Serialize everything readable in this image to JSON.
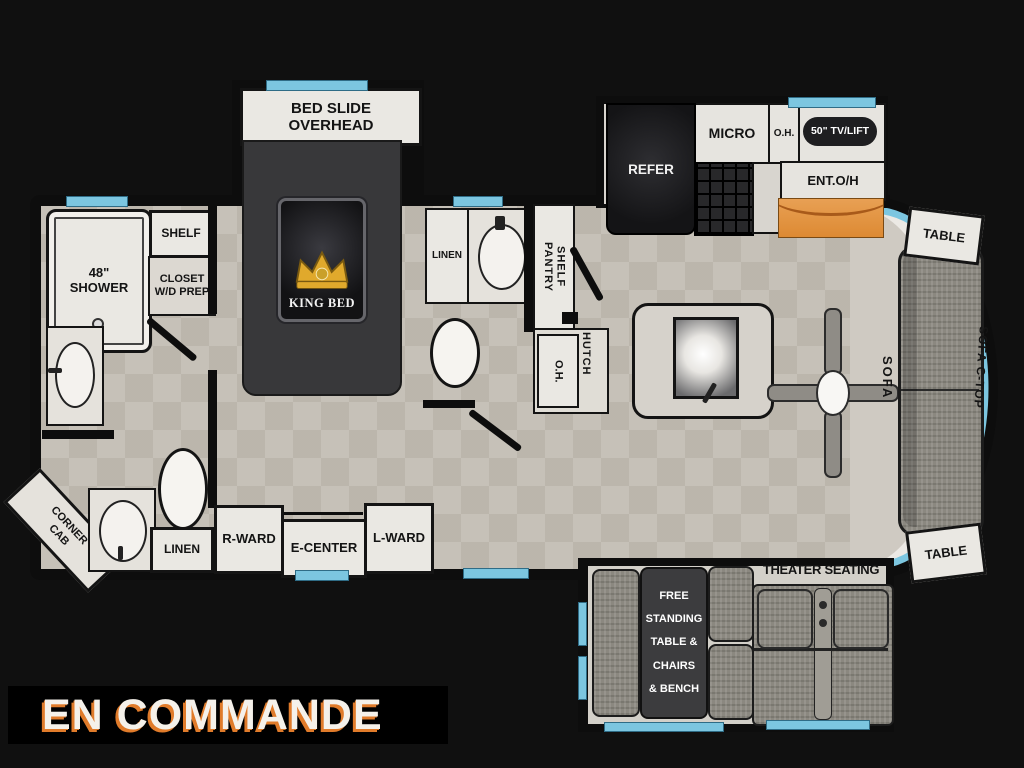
{
  "banner": {
    "text": "EN COMMANDE"
  },
  "colors": {
    "background": "#101010",
    "wall": "#0d0d0d",
    "floor_tile": "#c6c1b8",
    "window_blue": "#7cc6e0",
    "counter_orange": "#e0903c",
    "banner_text": "#f5f1ea",
    "banner_shadow_orange": "#e07b2a",
    "bed_dark": "#38383a"
  },
  "plan": {
    "front_bath": {
      "shower": "48\"\nSHOWER",
      "shelf": "SHELF",
      "closet": "CLOSET\nW/D PREP",
      "corner_cab": "CORNER\nCAB",
      "linen": "LINEN"
    },
    "bedroom": {
      "bed_slide": "BED SLIDE\nOVERHEAD",
      "king_bed": "KING BED",
      "r_ward": "R-WARD",
      "e_center": "E-CENTER",
      "l_ward": "L-WARD"
    },
    "mid_bath": {
      "linen": "LINEN"
    },
    "kitchen": {
      "pantry": "PANTRY\nSHELF",
      "oh_lower": "O.H.",
      "hutch": "HUTCH",
      "refer": "REFER",
      "micro": "MICRO",
      "oh_upper": "O.H.",
      "tv_lift": "50\" TV/LIFT",
      "ent_oh": "ENT.O/H"
    },
    "living": {
      "sofa": "SOFA",
      "sofa_ctop": "SOFA C-TOP",
      "table_rear": "TABLE",
      "table_front": "TABLE",
      "theater": "THEATER SEATING",
      "dinette": "FREE\nSTANDING\nTABLE &\nCHAIRS\n& BENCH"
    }
  }
}
